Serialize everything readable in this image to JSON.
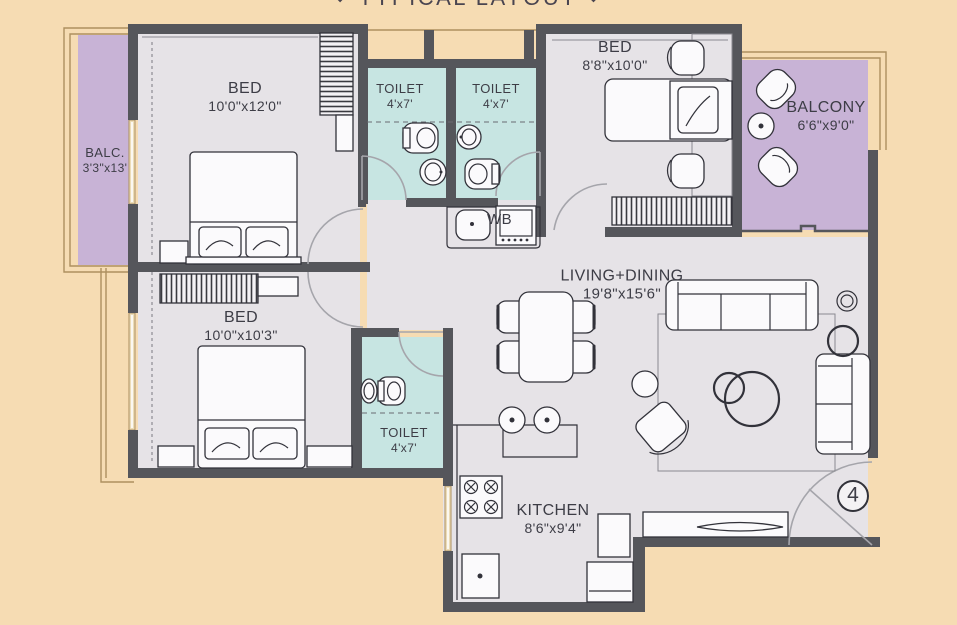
{
  "title": {
    "text": "TYPICAL LAYOUT",
    "ornament": "◆"
  },
  "unit_number": "4",
  "rooms": {
    "bed1": {
      "label": "BED",
      "dims": "10'0\"x12'0\""
    },
    "bed2": {
      "label": "BED",
      "dims": "8'8\"x10'0\""
    },
    "bed3": {
      "label": "BED",
      "dims": "10'0\"x10'3\""
    },
    "toilet1": {
      "label": "TOILET",
      "dims": "4'x7'"
    },
    "toilet2": {
      "label": "TOILET",
      "dims": "4'x7'"
    },
    "toilet3": {
      "label": "TOILET",
      "dims": "4'x7'"
    },
    "living": {
      "label": "LIVING+DINING",
      "dims": "19'8\"x15'6\""
    },
    "kitchen": {
      "label": "KITCHEN",
      "dims": "8'6\"x9'4\""
    },
    "balcony_left": {
      "label": "BALC.",
      "dims": "3'3\"x13'"
    },
    "balcony_right": {
      "label": "BALCONY",
      "dims": "6'6\"x9'0\""
    }
  },
  "annotations": {
    "wash_basin": "WB"
  },
  "colors": {
    "background": "#f6dcb3",
    "wall": "#55565b",
    "floor": "#e6e3e7",
    "toilet_floor": "#c7e5e2",
    "balcony_floor": "#c8b3d6",
    "line": "#32323a",
    "door": "#a5a5ab",
    "tan": "#ad9060",
    "label": "#3d3d46"
  }
}
